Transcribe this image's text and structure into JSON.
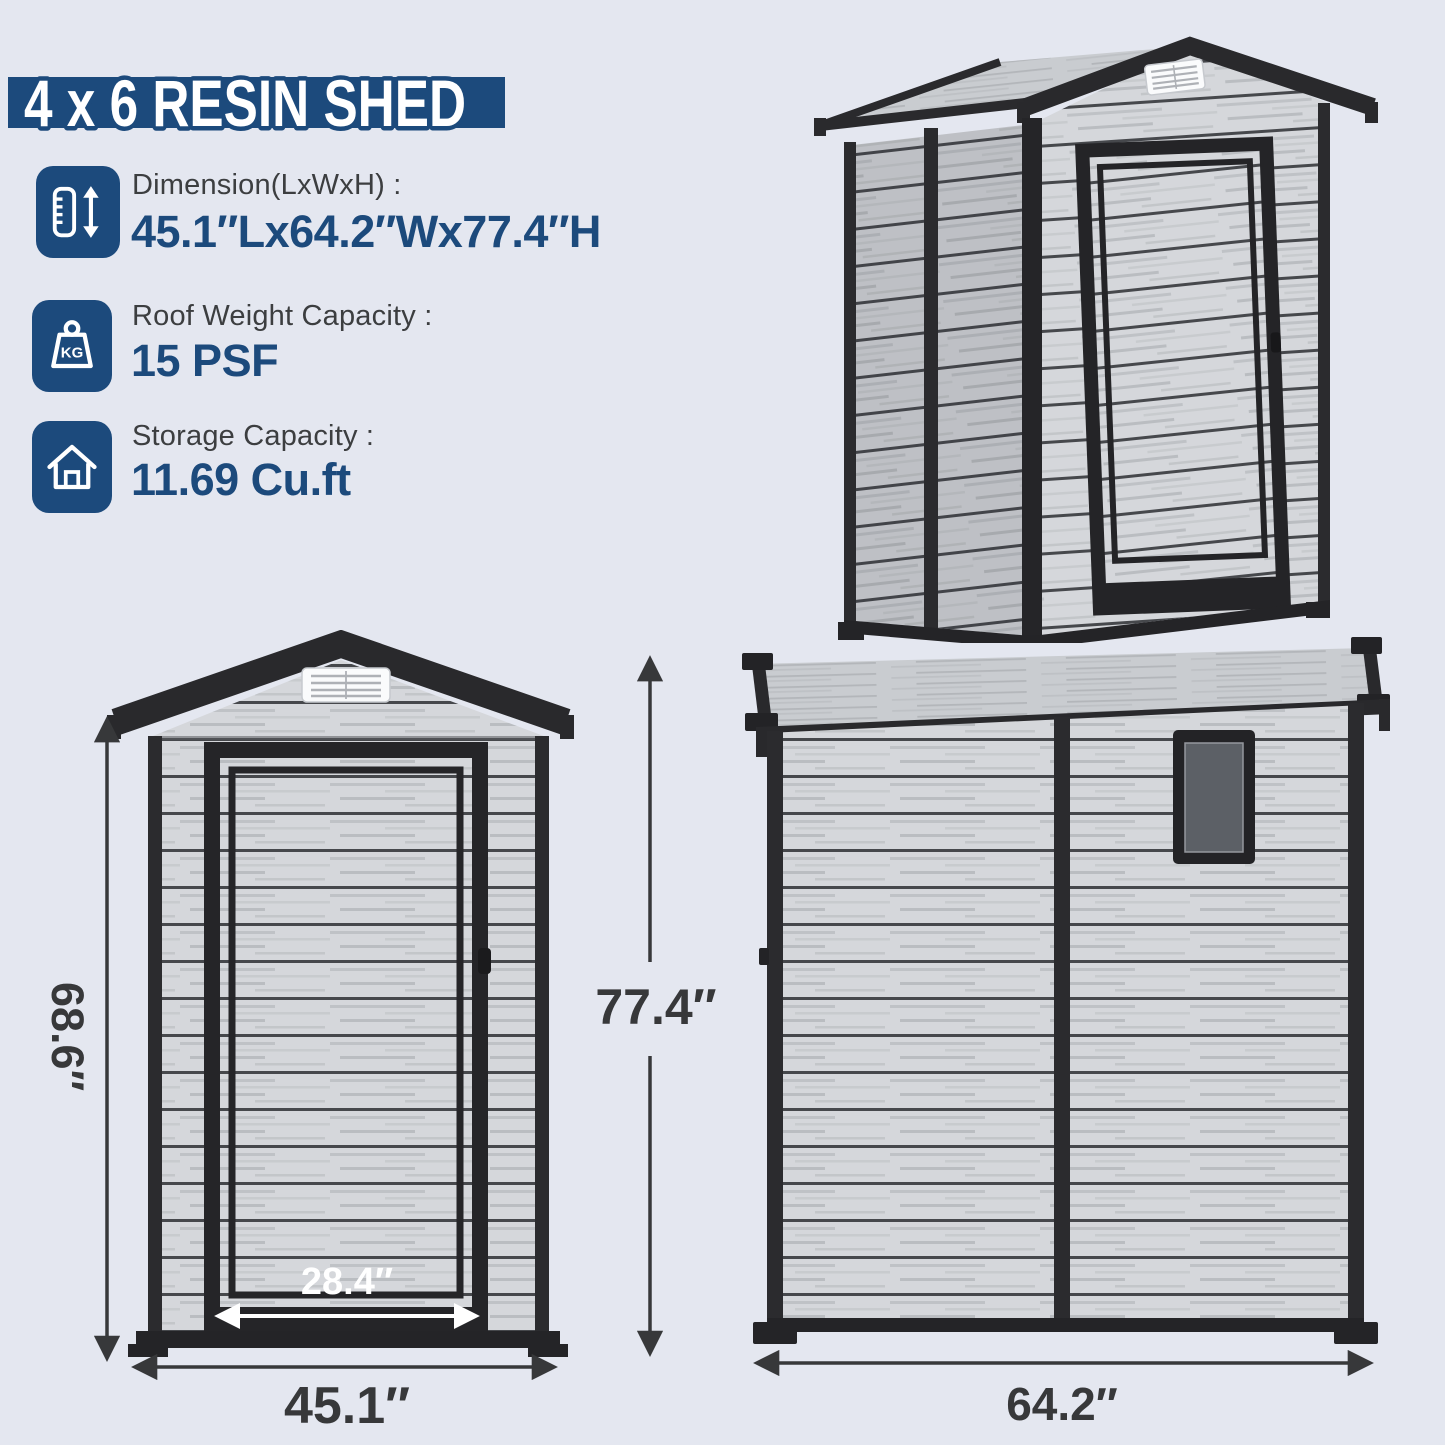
{
  "page": {
    "title": "4 x 6 RESIN SHED"
  },
  "colors": {
    "background": "#e4e7f0",
    "navy": "#1c4a7c",
    "trim_dark": "#29292c",
    "plank_base": "#d5d7db",
    "groove": "#46484c",
    "dimension_text": "#37383a",
    "vent_white": "#fafbfc",
    "window_glass": "#5c6066"
  },
  "specs": [
    {
      "icon": "height-ruler-icon",
      "label": "Dimension(LxWxH) :",
      "value": "45.1″Lx64.2″Wx77.4″H"
    },
    {
      "icon": "weight-kg-icon",
      "kg_text": "KG",
      "label": "Roof Weight Capacity :",
      "value": "15 PSF"
    },
    {
      "icon": "house-storage-icon",
      "label": "Storage Capacity :",
      "value": "11.69 Cu.ft"
    }
  ],
  "dimensions": {
    "front_wall_height": "68.6″",
    "total_height": "77.4″",
    "front_width": "45.1″",
    "door_width": "28.4″",
    "side_width": "64.2″"
  }
}
